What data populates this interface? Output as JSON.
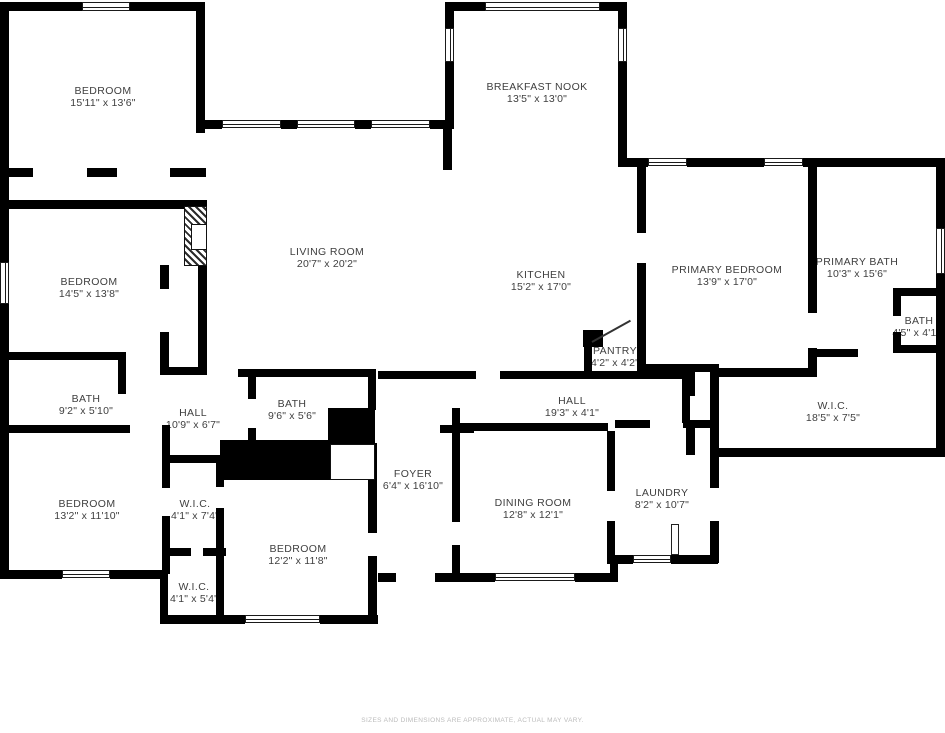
{
  "title": "Floor plan",
  "disclaimer": "SIZES AND DIMENSIONS ARE APPROXIMATE, ACTUAL MAY VARY.",
  "colors": {
    "wall": "#000000",
    "floor": "#ffffff",
    "label": "#3f3f3f",
    "disclaimer_text": "#bcbcbc"
  },
  "rooms": [
    {
      "name": "BEDROOM",
      "dims": "15'11\" x 13'6\""
    },
    {
      "name": "BREAKFAST NOOK",
      "dims": "13'5\" x 13'0\""
    },
    {
      "name": "BEDROOM",
      "dims": "14'5\" x 13'8\""
    },
    {
      "name": "LIVING ROOM",
      "dims": "20'7\" x 20'2\""
    },
    {
      "name": "KITCHEN",
      "dims": "15'2\" x 17'0\""
    },
    {
      "name": "PRIMARY BEDROOM",
      "dims": "13'9\" x 17'0\""
    },
    {
      "name": "PRIMARY BATH",
      "dims": "10'3\" x 15'6\""
    },
    {
      "name": "BATH",
      "dims": "4'5\" x 4'11\""
    },
    {
      "name": "PANTRY",
      "dims": "4'2\" x 4'2\""
    },
    {
      "name": "BATH",
      "dims": "9'2\" x 5'10\""
    },
    {
      "name": "HALL",
      "dims": "10'9\" x 6'7\""
    },
    {
      "name": "BATH",
      "dims": "9'6\" x 5'6\""
    },
    {
      "name": "HALL",
      "dims": "19'3\" x 4'1\""
    },
    {
      "name": "W.I.C.",
      "dims": "18'5\" x 7'5\""
    },
    {
      "name": "BEDROOM",
      "dims": "13'2\" x 11'10\""
    },
    {
      "name": "W.I.C.",
      "dims": "4'1\" x 7'4\""
    },
    {
      "name": "FOYER",
      "dims": "6'4\" x 16'10\""
    },
    {
      "name": "DINING ROOM",
      "dims": "12'8\" x 12'1\""
    },
    {
      "name": "LAUNDRY",
      "dims": "8'2\" x 10'7\""
    },
    {
      "name": "BEDROOM",
      "dims": "12'2\" x 11'8\""
    },
    {
      "name": "W.I.C.",
      "dims": "4'1\" x 5'4\""
    }
  ]
}
